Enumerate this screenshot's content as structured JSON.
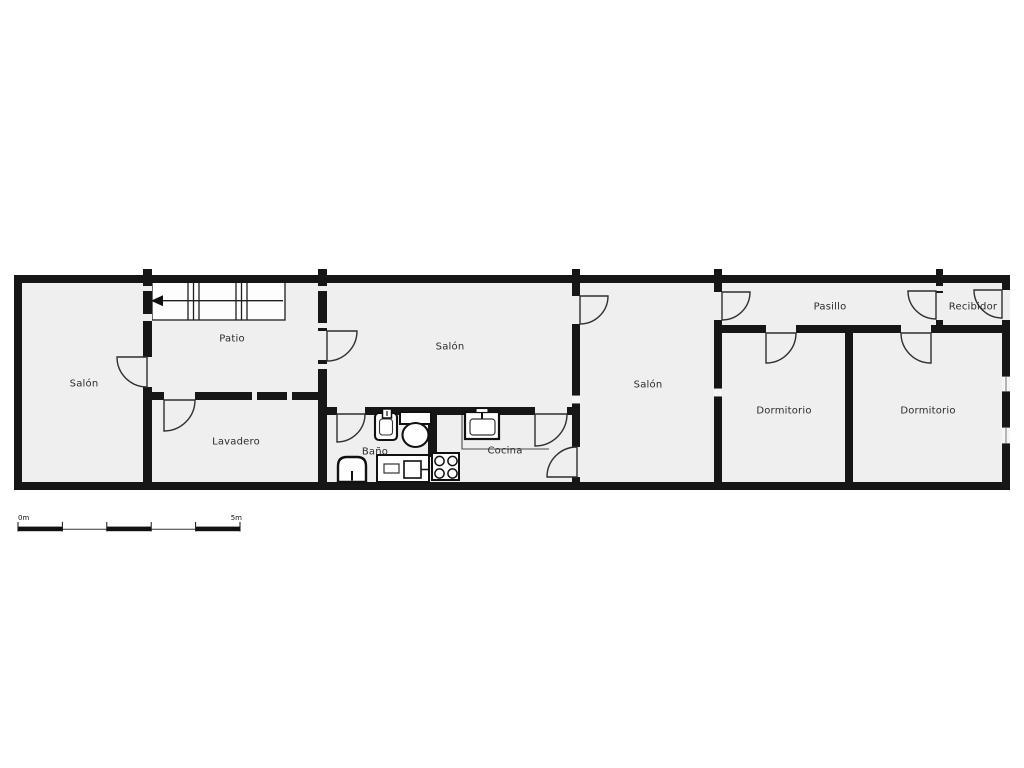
{
  "plan": {
    "type": "floor-plan",
    "rooms": [
      {
        "id": "salon-left",
        "label": "Salón"
      },
      {
        "id": "patio",
        "label": "Patio"
      },
      {
        "id": "lavadero",
        "label": "Lavadero"
      },
      {
        "id": "salon-center",
        "label": "Salón"
      },
      {
        "id": "bano",
        "label": "Baño"
      },
      {
        "id": "cocina",
        "label": "Cocina"
      },
      {
        "id": "salon-right",
        "label": "Salón"
      },
      {
        "id": "dormitorio-1",
        "label": "Dormitorio"
      },
      {
        "id": "dormitorio-2",
        "label": "Dormitorio"
      },
      {
        "id": "pasillo",
        "label": "Pasillo"
      },
      {
        "id": "recibidor",
        "label": "Recibidor"
      }
    ],
    "fixtures": [
      "stairs-with-arrow",
      "bath-sink",
      "toilet",
      "shower-tray",
      "washing-machine",
      "kitchen-sink",
      "stove-4-burners",
      "kitchen-counter"
    ],
    "doors": 12,
    "windows": 4,
    "scale_bar": {
      "start_label": "0m",
      "end_label": "5m"
    },
    "colors": {
      "wall": "#161616",
      "floor": "#efefef",
      "background": "#ffffff",
      "line": "#2f2f2f"
    }
  }
}
